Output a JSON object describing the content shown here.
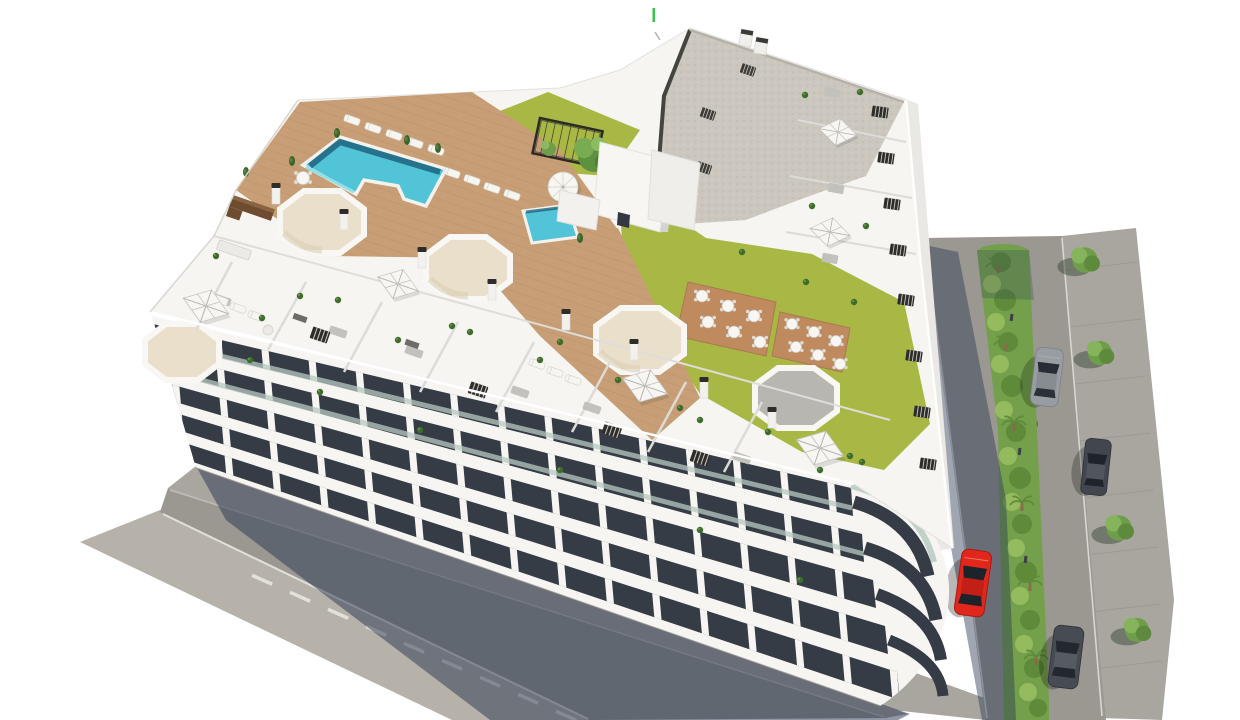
{
  "scene": {
    "description": "Aerial 3D architectural rendering of a modern white residential apartment block. The rooftop holds a turquoise swimming pool and a small kids pool on a wooden sun deck with loungers and a round white parasol, a black pergola, olive-green lawns with terracotta dining patios, five octagonal skylight wells, and penthouse terraces with square canvas parasols, sofas and spiral stairs; the right section has a grey gravel roof with vents and white cores. A shadowed street with a dashed lane line runs along the lower-left facade; a two-lane road with a planted palm median, sidewalk trees, one red car, one silver car and two dark cars runs along the right.",
    "building": {
      "floors_visible": 6,
      "rooftop_features": [
        "main pool",
        "kids pool",
        "wooden sun deck",
        "sun loungers",
        "round parasol",
        "pergola",
        "lawns",
        "dining patios",
        "octagonal skylights",
        "penthouse terraces",
        "square parasols",
        "spiral stairs",
        "gravel roof with vents"
      ]
    },
    "streets": {
      "southwest": [
        "asphalt in building shadow",
        "dashed lane line",
        "sidewalks"
      ],
      "northeast": [
        "two lanes",
        "green median with palms and shrubs",
        "paved sidewalk with trees",
        "manhole cover"
      ]
    },
    "counts": {
      "skylights_octagonal": 5,
      "square_parasols": 6,
      "round_parasols": 1,
      "pools": 2,
      "vehicles_red": 1,
      "vehicles_silver": 1,
      "vehicles_dark": 2,
      "sidewalk_trees": 4
    }
  },
  "colors": {
    "bg": "#ffffff",
    "wall": "#f6f5f2",
    "wallShade": "#e9e8e4",
    "glass": "#353c46",
    "glassDark": "#21262e",
    "rail": "#b7c9c1",
    "deck": "#c79e75",
    "pool": "#52c4d8",
    "poolDeep": "#1f6480",
    "poolLight": "#8adce8",
    "sand": "#eadfca",
    "sandShade": "#d9cdb3",
    "lawn": "#a9b845",
    "patio": "#bf8a5e",
    "gravel": "#cbc7bf",
    "gravelTrim": "#45453f",
    "street": "#9b9892",
    "streetSun": "#b6b2aa",
    "sidewalk": "#a9a6a0",
    "median": "#74a04c",
    "bush": "#5e8a3a",
    "bushLight": "#95bb5f",
    "shadow": "#2c3a52",
    "carRed": "#e1271c",
    "carGray": "#989da1",
    "carDark": "#42464e",
    "umbrella": "#f7f6f2",
    "furniture": "#c3c1bb",
    "furnitureDark": "#6e6c66",
    "counter": "#6e4c2f",
    "stair": "#2f2d29",
    "tree": "#6f9e4a",
    "treeLight": "#8cb763",
    "palmTrunk": "#8a6b49",
    "tick": "#39c24d"
  }
}
